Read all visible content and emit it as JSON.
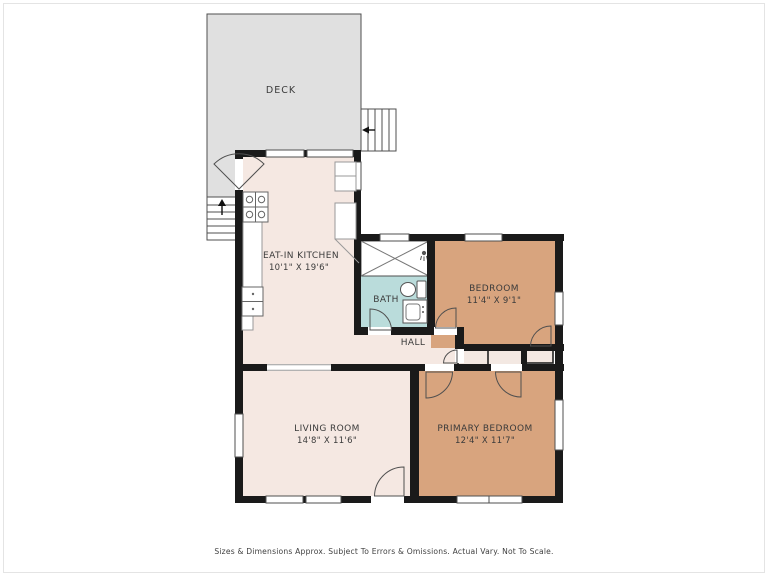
{
  "title": "Floor Plan",
  "palette": {
    "wall": "#1a1a1a",
    "thin_line": "#4f4f4f",
    "floor_main": "#f5e8e2",
    "floor_bedroom": "#d8a47e",
    "floor_bath": "#badcdb",
    "deck_fill": "#e0e0e0",
    "closet_fill": "#f3e8e2",
    "label_color": "#3b3b3b"
  },
  "rooms": [
    {
      "name": "DECK",
      "dims": ""
    },
    {
      "name": "EAT-IN KITCHEN",
      "dims": "10'1\" X 19'6\""
    },
    {
      "name": "BATH",
      "dims": ""
    },
    {
      "name": "BEDROOM",
      "dims": "11'4\" X 9'1\""
    },
    {
      "name": "HALL",
      "dims": ""
    },
    {
      "name": "LIVING ROOM",
      "dims": "14'8\" X 11'6\""
    },
    {
      "name": "PRIMARY BEDROOM",
      "dims": "12'4\" X 11'7\""
    }
  ],
  "features": {
    "icons": [
      "stairs-up-icon",
      "stairs-down-icon",
      "stove-icon",
      "kitchen-sink-icon",
      "shower-tub-icon",
      "showerhead-icon",
      "toilet-icon",
      "bath-sink-icon",
      "door-swing-icon",
      "window-icon",
      "closet-icon"
    ]
  },
  "footer": {
    "disclaimer": "Sizes & Dimensions Approx. Subject To Errors & Omissions. Actual Vary. Not To Scale."
  }
}
